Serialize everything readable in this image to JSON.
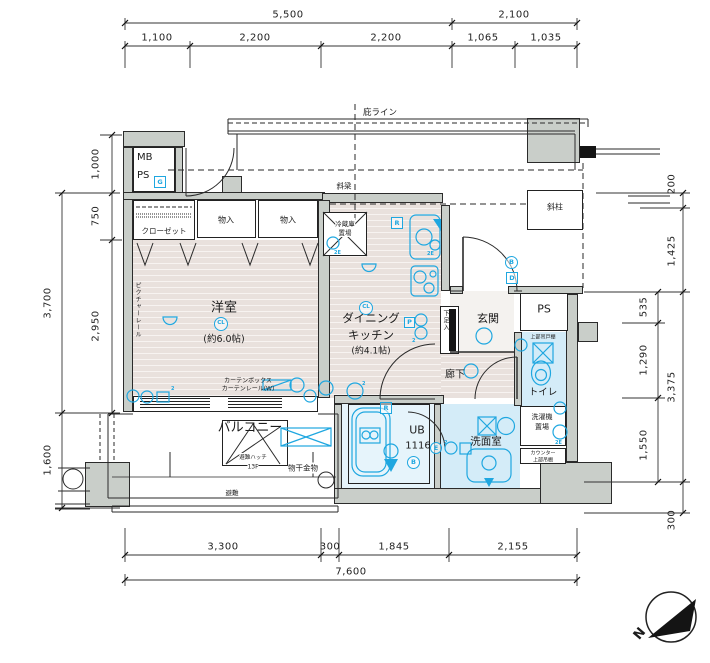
{
  "dims": {
    "top_outer": [
      "5,500",
      "2,100"
    ],
    "top_inner": [
      "1,100",
      "2,200",
      "2,200",
      "1,065",
      "1,035"
    ],
    "bottom_inner": [
      "3,300",
      "300",
      "1,845",
      "2,155"
    ],
    "bottom_outer": "7,600",
    "left": {
      "d1000": "1,000",
      "d750": "750",
      "d2950": "2,950",
      "d3700": "3,700",
      "d1600": "1,600"
    },
    "right": {
      "d200": "200",
      "d1425": "1,425",
      "d535": "535",
      "d1290": "1,290",
      "d1550": "1,550",
      "d3375": "3,375",
      "d300": "300"
    }
  },
  "rooms": {
    "yoshitsu": {
      "name": "洋室",
      "size": "(約6.0帖)"
    },
    "dk": {
      "line1": "ダイニング",
      "line2": "キッチン",
      "size": "(約4.1帖)"
    },
    "genkan": "玄関",
    "rouka": "廊下",
    "toilet": "トイレ",
    "senmen": "洗面室",
    "ub": {
      "name": "UB",
      "size": "1116"
    },
    "balcony": "バルコニー",
    "mb": "MB",
    "ps": "PS",
    "ps2": "PS"
  },
  "fixtures": {
    "closet": "クローゼット",
    "monoire1": "物入",
    "monoire2": "物入",
    "fridge1": "冷蔵庫",
    "fridge2": "置場",
    "shoebox": "下足入",
    "washer1": "洗濯機",
    "washer2": "置場",
    "counter1": "カウンター",
    "counter2": "上部吊棚",
    "toilet_shelf": "上部吊戸棚",
    "hatch": "避難ハッチ",
    "hatch_floor": "13F",
    "monohoshi": "物干金物",
    "hinan": "避難",
    "picture_rail": "ピクチャーレール",
    "curtain1": "カーテンボックス",
    "curtain2": "カーテンレール(W)"
  },
  "annotations": {
    "hisashi": "庇ライン",
    "sharyo": "斜梁",
    "shachu": "斜柱"
  },
  "symbols": {
    "cl": "CL",
    "r": "R",
    "b": "B",
    "d": "D",
    "g": "G",
    "p": "P",
    "e": "E",
    "e2": "2E",
    "two": "2",
    "n": "N"
  },
  "colors": {
    "symbol_blue": "#1fa7e0",
    "wall_gray": "#c9cec9",
    "wood_floor": "#e9e1dd",
    "wet_floor": "#d4ecf8"
  }
}
